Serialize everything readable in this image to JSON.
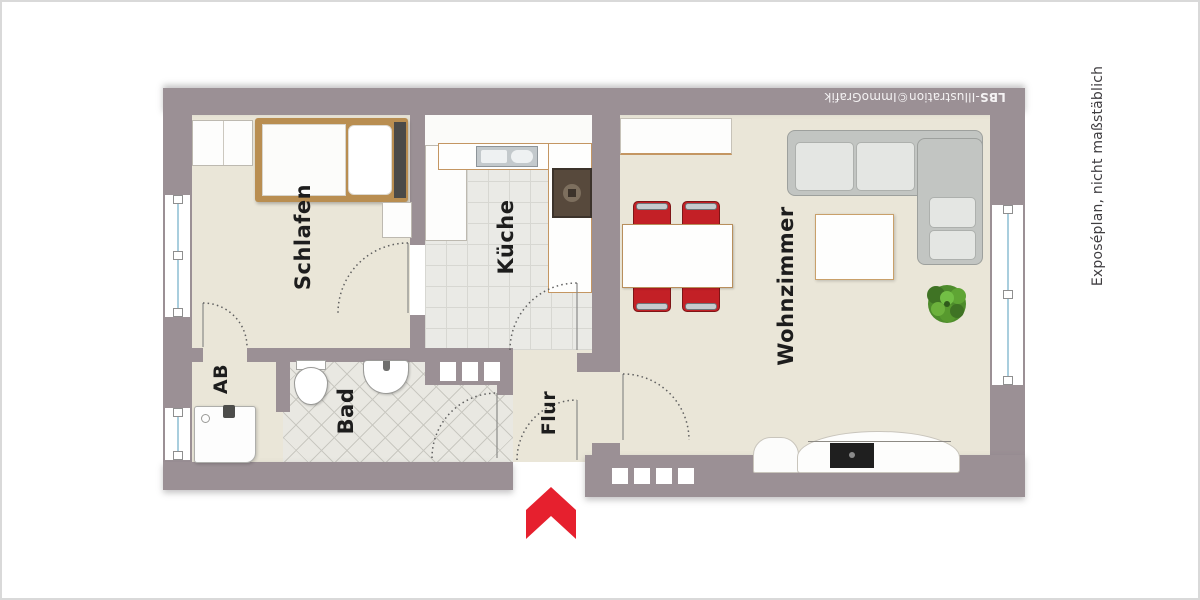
{
  "floorplan": {
    "rooms": {
      "schlafen": "Schlafen",
      "kueche": "Küche",
      "wohnzimmer": "Wohnzimmer",
      "bad": "Bad",
      "ab": "AB",
      "flur": "Flur"
    },
    "watermark": {
      "brand": "LBS",
      "rest": "-Illustration©ImmoGrafik"
    },
    "disclaimer": "Exposéplan, nicht maßstäblich",
    "colors": {
      "wall": "#9b9095",
      "floor": "#eae6d8",
      "bed_frame": "#b98e51",
      "chair_red": "#c32026",
      "entrance_arrow_red": "#e6202e",
      "plant_green": "#57992e",
      "window_glass_blue": "#a9cede"
    },
    "furniture": [
      "wardrobe",
      "bed",
      "nightstand",
      "kitchen-counter",
      "kitchen-sink",
      "stove",
      "sideboard",
      "dining-table",
      "chair",
      "corner-sofa",
      "coffee-table",
      "plant",
      "tv-lowboard",
      "toilet",
      "washbasin",
      "shower",
      "window",
      "glass-blocks",
      "door-arc",
      "entrance-arrow"
    ]
  }
}
